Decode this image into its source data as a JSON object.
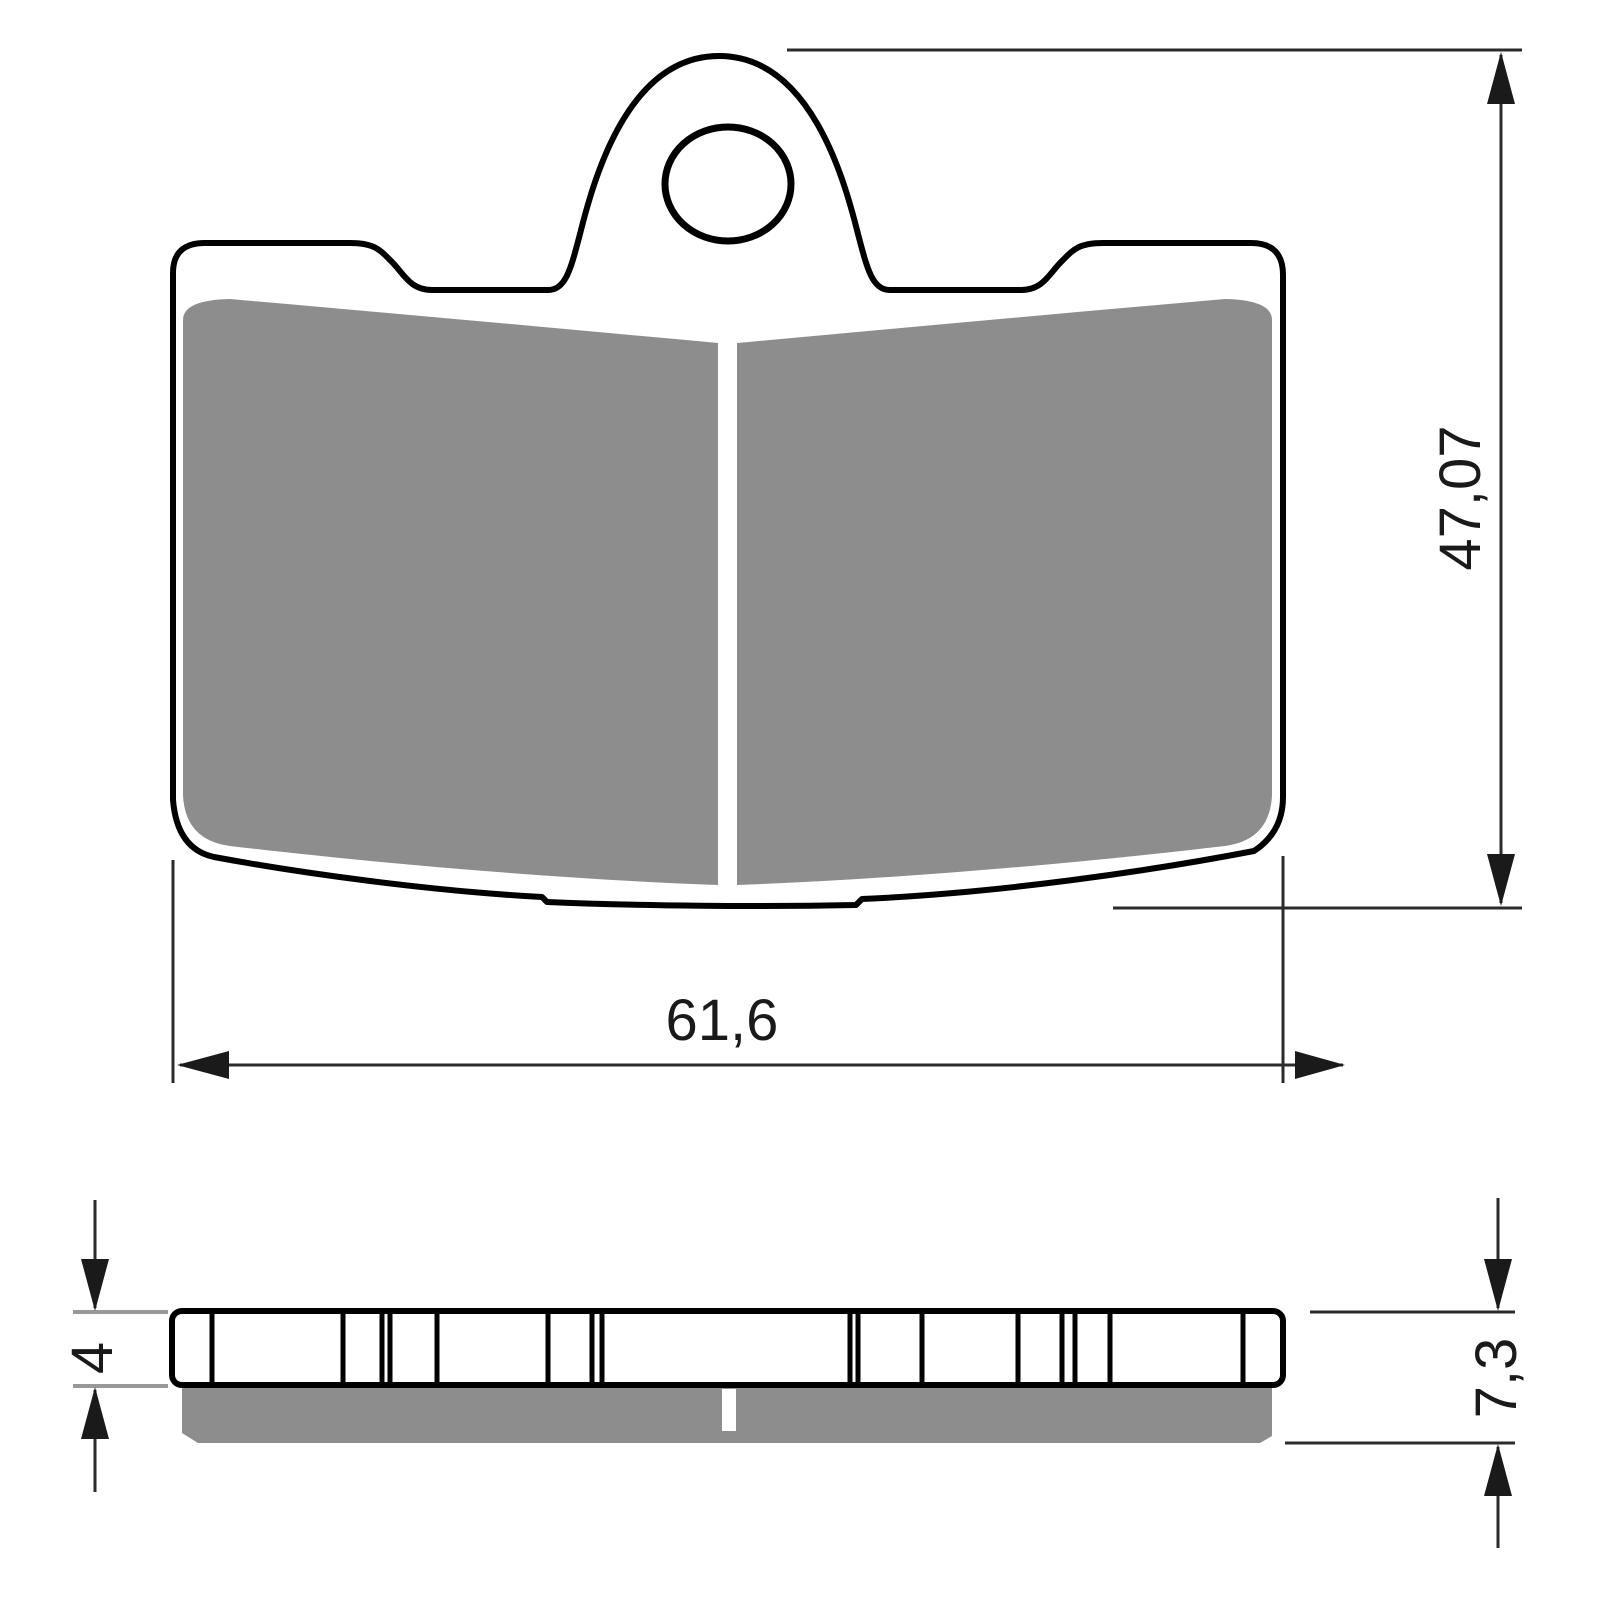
{
  "dimensions": {
    "width_label": "61,6",
    "height_label": "47,07",
    "plate_thickness_label": "4",
    "total_thickness_label": "7,3"
  },
  "colors": {
    "background": "#ffffff",
    "outline": "#000000",
    "friction_material": "#8d8d8d",
    "dimension_line": "#2b2b2b",
    "tick_line": "#999999"
  }
}
